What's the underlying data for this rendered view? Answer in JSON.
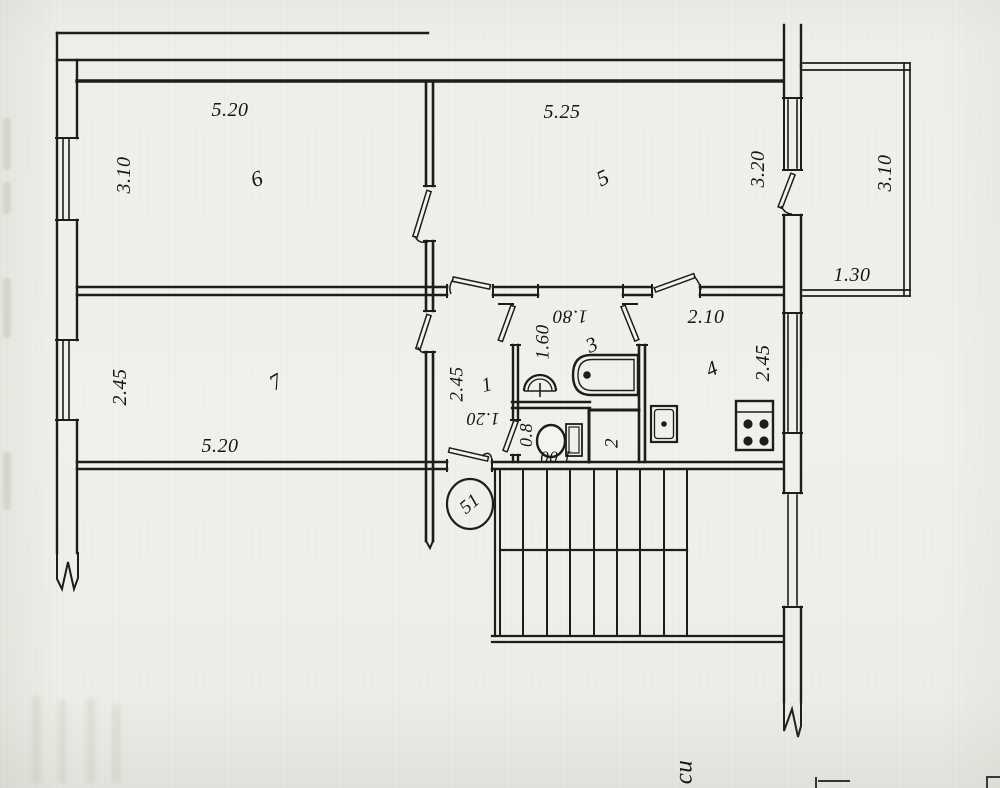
{
  "plan": {
    "kind": "apartment floor plan (scanned blueprint)",
    "unit_number": "51",
    "room_numbers": [
      "1",
      "2",
      "3",
      "4",
      "5",
      "6",
      "7"
    ],
    "margin_note": "си"
  },
  "colors": {
    "paper_plan": "#f1f1eb",
    "paper_margin": "#e9eae4",
    "ink": "#1d1d1d"
  },
  "labels": {
    "dim_520_top": "5.20",
    "dim_310_room6": "3.10",
    "room_6": "6",
    "dim_525_room5": "5.25",
    "room_5": "5",
    "dim_320_wall": "3.20",
    "dim_310_balcony": "3.10",
    "dim_130_balcony": "1.30",
    "dim_210_kitchen": "2.10",
    "room_4": "4",
    "dim_245_kitchen": "2.45",
    "dim_180_bath": "1.80",
    "dim_160_bath": "1.60",
    "room_3": "3",
    "room_1": "1",
    "dim_245_hall": "2.45",
    "dim_120_hall": "1.20",
    "dim_08_wc": "0.8",
    "dim_100_wc": "1.00",
    "room_2": "2",
    "room_7": "7",
    "dim_245_room7": "2.45",
    "dim_520_room7": "5.20",
    "unit_number": "51",
    "margin_note": "си"
  },
  "icons": [
    "bathtub-icon",
    "bath-sink-icon",
    "toilet-icon",
    "kitchen-sink-icon",
    "stove-icon",
    "stairs-icon",
    "window-icon",
    "door-leaf-icon"
  ]
}
